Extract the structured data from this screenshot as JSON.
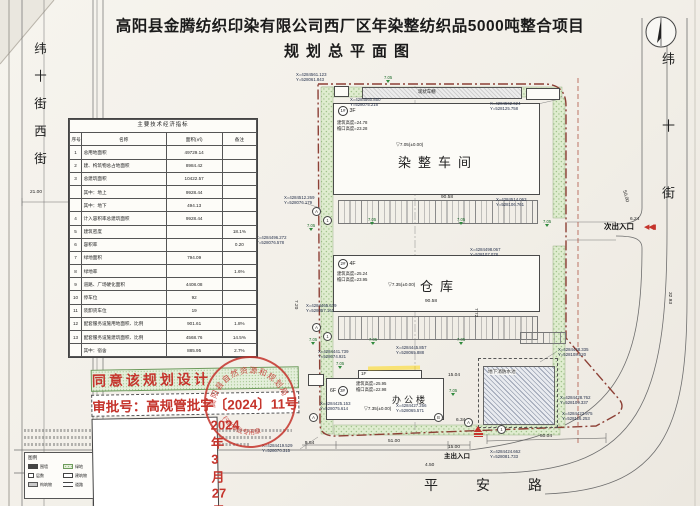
{
  "title": {
    "line1": "高阳县金腾纺织印染有限公司西厂区年染整纺织品5000吨整合项目",
    "line2": "规划总平面图"
  },
  "streets": {
    "west": "纬十街西街",
    "east": "纬十街",
    "south": "平安路"
  },
  "approval": {
    "line1": "同意该规划设计",
    "line2": "审批号：高规管批字〔2024〕11号",
    "line3": "2024年3月27日",
    "seal_org": "高阳县自然资源和规划局",
    "seal_text": "行政审批专用章"
  },
  "table": {
    "title": "主要技术经济指标",
    "columns": [
      "序号",
      "名称",
      "面积(㎡)",
      "备注"
    ],
    "rows": [
      [
        "1",
        "总用地面积",
        "49729.14",
        ""
      ],
      [
        "2",
        "建、构筑物总占地面积",
        "8984.42",
        ""
      ],
      [
        "3",
        "总建筑面积",
        "10422.57",
        ""
      ],
      [
        "",
        "其中：地上",
        "9928.44",
        ""
      ],
      [
        "",
        "其中：地下",
        "494.13",
        ""
      ],
      [
        "4",
        "计入容积率总建筑面积",
        "9928.44",
        ""
      ],
      [
        "5",
        "建筑密度",
        "",
        "18.1%"
      ],
      [
        "6",
        "容积率",
        "",
        "0.20"
      ],
      [
        "7",
        "绿地面积",
        "794.09",
        ""
      ],
      [
        "8",
        "绿地率",
        "",
        "1.6%"
      ],
      [
        "9",
        "道路、广场硬化面积",
        "4408.08",
        ""
      ],
      [
        "10",
        "停车位",
        "92",
        ""
      ],
      [
        "11",
        "装卸货车位",
        "19",
        ""
      ],
      [
        "12",
        "配套服务设施用地面积、比例",
        "901.61",
        "1.8%"
      ],
      [
        "13",
        "配套服务设施建筑面积、比例",
        "4568.76",
        "14.5%"
      ],
      [
        "",
        "其中：宿舍",
        "885.95",
        "2.7%"
      ]
    ]
  },
  "legend": {
    "title": "图例",
    "items": [
      "围墙",
      "绿地",
      "机动车停车位",
      "层数",
      "建筑物",
      "出入口",
      "构筑物",
      "道路"
    ]
  },
  "buildings": [
    {
      "tag": "1#",
      "floors": "3F",
      "name": "染整车间",
      "attr1": "建筑高度=24.78",
      "attr2": "檐口高度=23.28",
      "elev": "7.05(±0.00)"
    },
    {
      "tag": "2#",
      "floors": "4F",
      "name": "仓库",
      "attr1": "建筑高度=25.24",
      "attr2": "檐口高度=23.95",
      "elev": "7.35(±0.00)"
    },
    {
      "tag": "3#",
      "floors": "6F",
      "name": "办公楼",
      "attr1": "建筑高度=25.95",
      "attr2": "檐口高度=22.98",
      "elev": "7.35(±0.00)"
    }
  ],
  "labels": {
    "pool": "地下消防水池",
    "shed": "现状车棚",
    "annex": "1F",
    "main_entrance": "主出入口",
    "secondary_entrance": "次出入口"
  },
  "plan": {
    "elev_label": "7.05",
    "axis_markers": [
      "A",
      "1",
      "A",
      "1",
      "A",
      "B",
      "A",
      "1"
    ],
    "dims": [
      "21.00",
      "90.58",
      "90.58",
      "50.04",
      "51.00",
      "15.00",
      "15.04",
      "6.34",
      "6.24",
      "5.54",
      "32.93",
      "50.00",
      "4.50",
      "7.20",
      "7.72"
    ],
    "coords": [
      {
        "x": "X=4284561.123",
        "y": "Y=528061.843"
      },
      {
        "x": "X=4284560.850",
        "y": "Y=528075.216"
      },
      {
        "x": "X=4284562.624",
        "y": "Y=528125.758"
      },
      {
        "x": "X=4284512.269",
        "y": "Y=528076.179"
      },
      {
        "x": "X=4284496.272",
        "y": "Y=528076.578"
      },
      {
        "x": "X=4284514.063",
        "y": "Y=528106.761"
      },
      {
        "x": "X=4284498.067",
        "y": "Y=528107.078"
      },
      {
        "x": "X=4284465.679",
        "y": "Y=528057.161"
      },
      {
        "x": "X=4284441.739",
        "y": "Y=528074.921"
      },
      {
        "x": "X=4284445.857",
        "y": "Y=528065.888"
      },
      {
        "x": "X=4284425.153",
        "y": "Y=528075.614"
      },
      {
        "x": "X=4284427.256",
        "y": "Y=528065.571"
      },
      {
        "x": "X=4284448.335",
        "y": "Y=528108.520"
      },
      {
        "x": "X=4284428.762",
        "y": "Y=528109.337"
      },
      {
        "x": "X=4284423.975",
        "y": "Y=528116.253"
      },
      {
        "x": "X=4284424.662",
        "y": "Y=528081.733"
      },
      {
        "x": "X=4284419.529",
        "y": "Y=528070.315"
      }
    ]
  }
}
